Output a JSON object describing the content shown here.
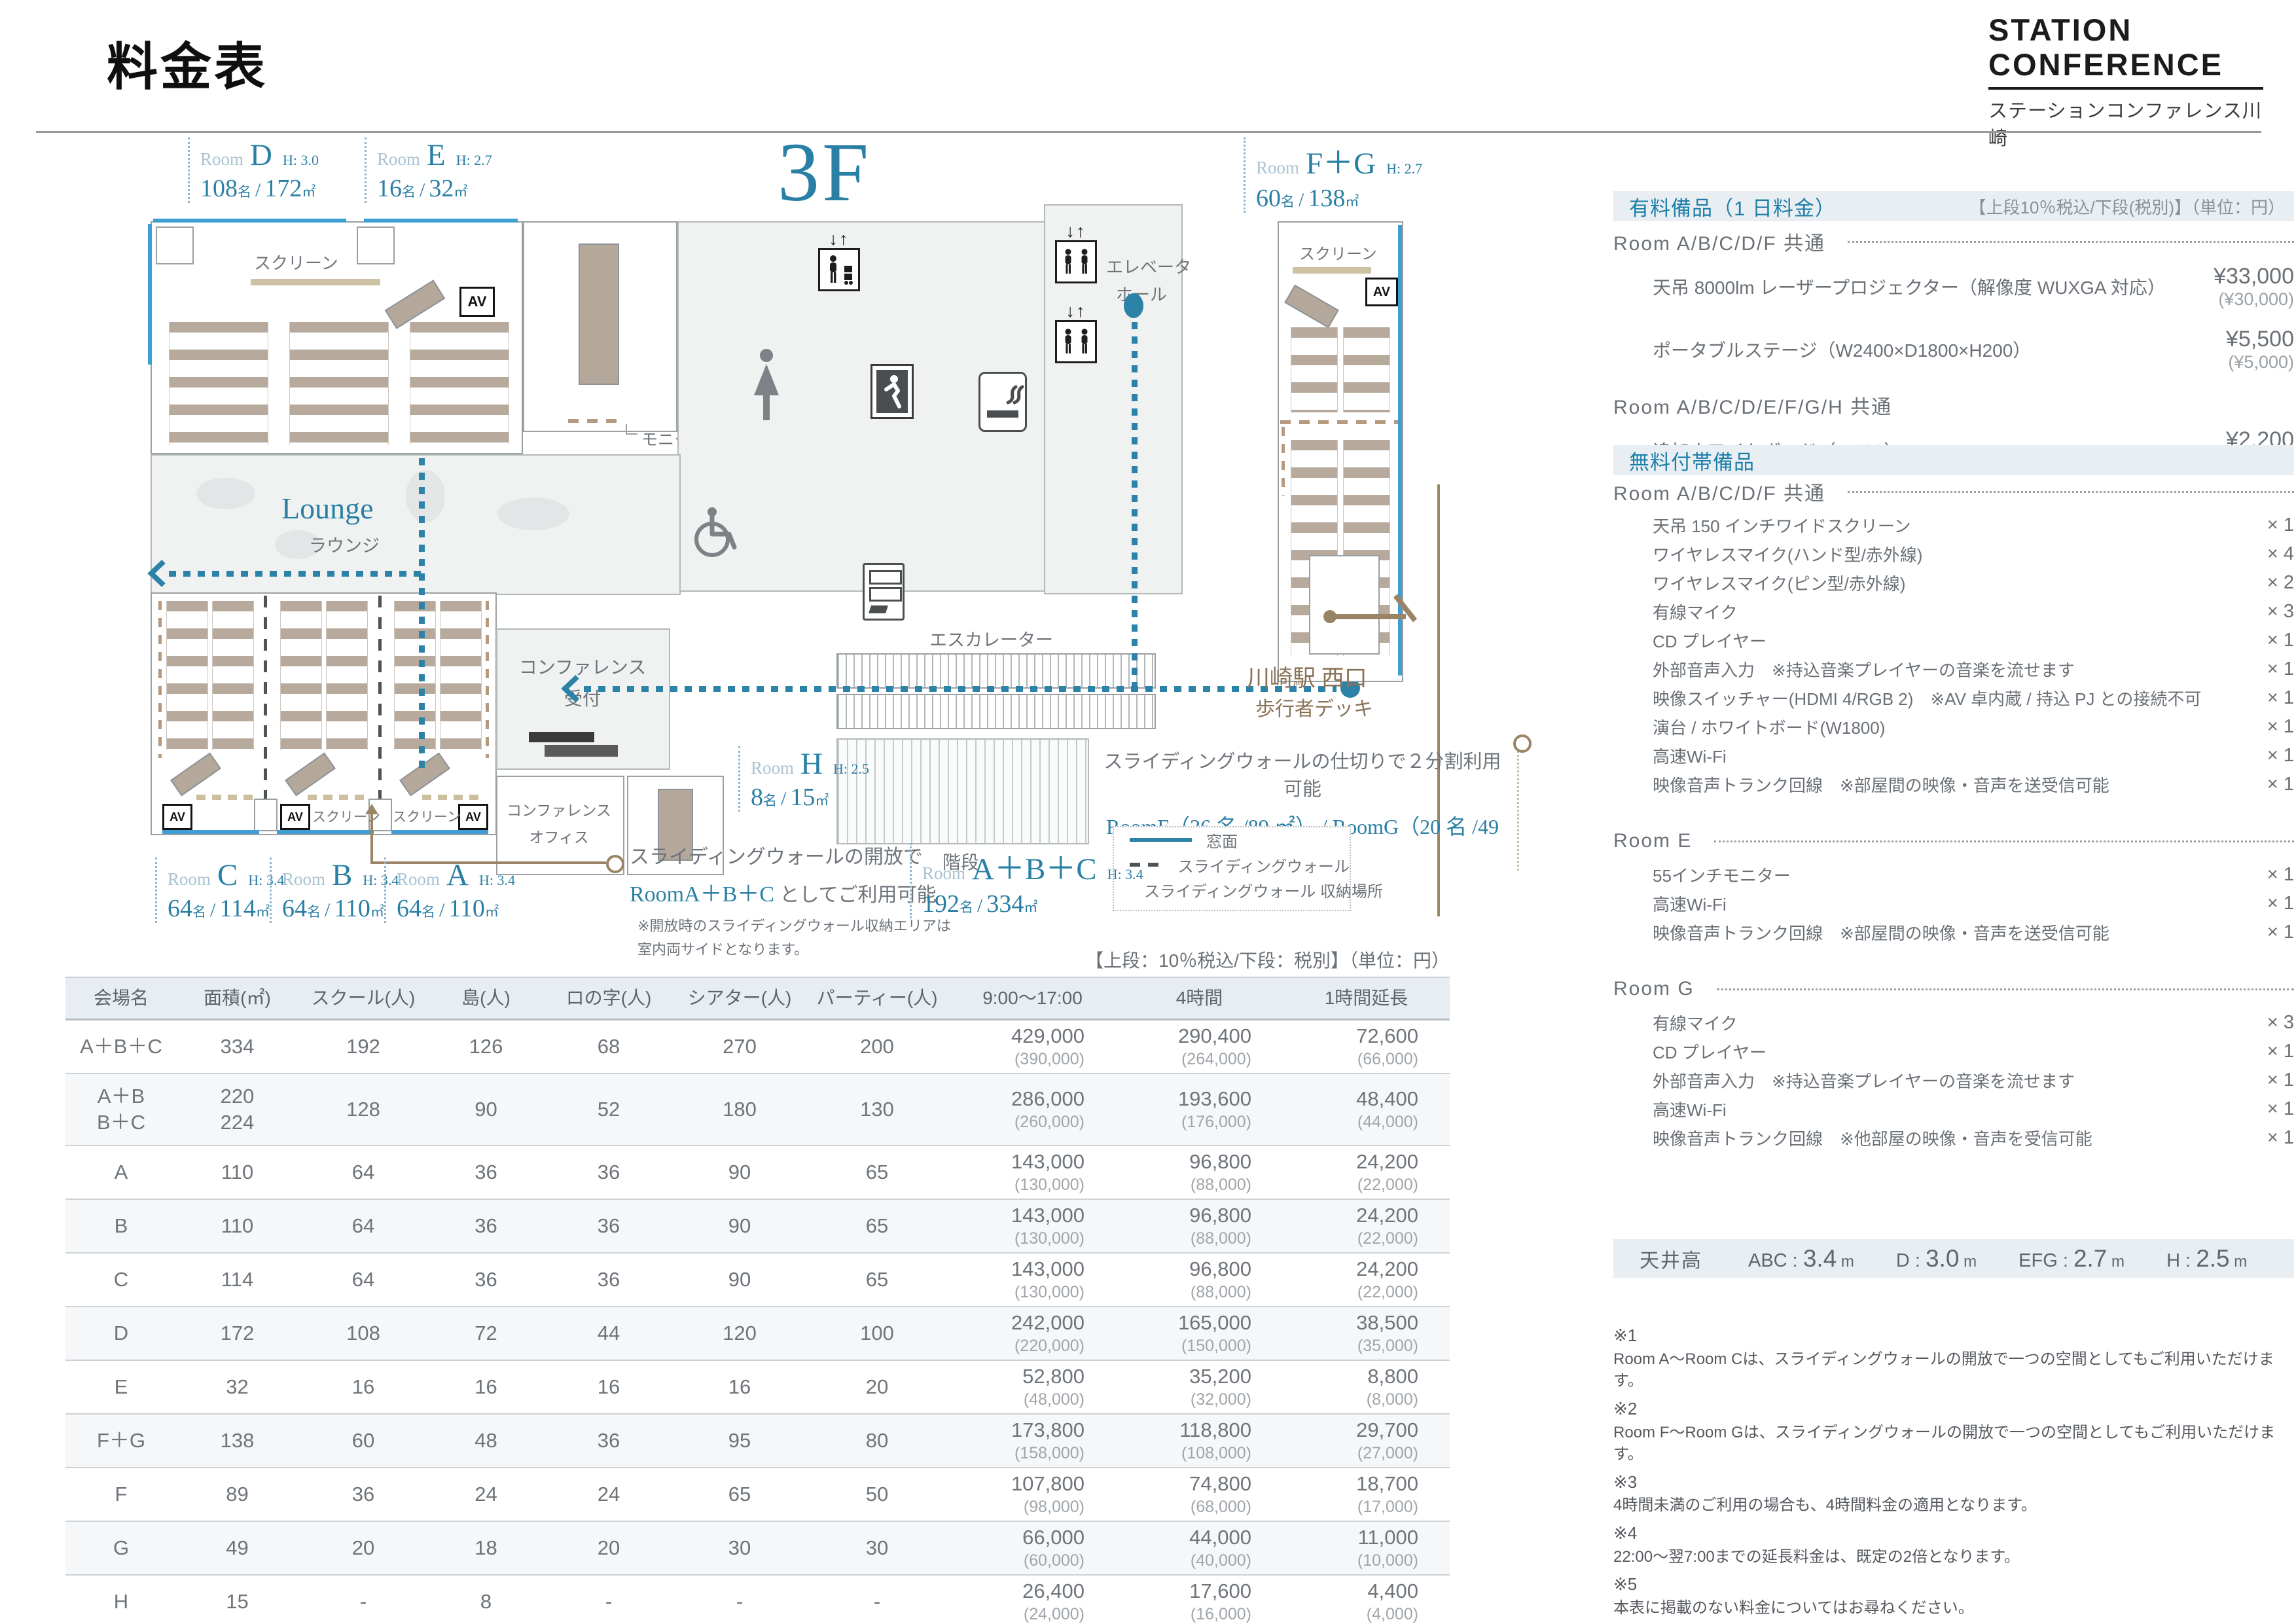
{
  "header": {
    "title": "料金表",
    "brand": {
      "line1": "STATION",
      "line2": "CONFERENCE",
      "subtitle": "ステーションコンファレンス川崎"
    }
  },
  "floor_plan": {
    "floor_label": "3F",
    "unit_name": "名",
    "unit_area": "㎡",
    "room_tags": [
      {
        "id": "d",
        "prefix": "Room",
        "letter": "D",
        "height": "H: 3.0",
        "capacity": "108",
        "area": "172"
      },
      {
        "id": "e",
        "prefix": "Room",
        "letter": "E",
        "height": "H: 2.7",
        "capacity": "16",
        "area": "32"
      },
      {
        "id": "fg",
        "prefix": "Room",
        "letter": "F＋G",
        "height": "H: 2.7",
        "capacity": "60",
        "area": "138"
      },
      {
        "id": "h",
        "prefix": "Room",
        "letter": "H",
        "height": "H: 2.5",
        "capacity": "8",
        "area": "15"
      },
      {
        "id": "c",
        "prefix": "Room",
        "letter": "C",
        "height": "H: 3.4",
        "capacity": "64",
        "area": "114"
      },
      {
        "id": "b",
        "prefix": "Room",
        "letter": "B",
        "height": "H: 3.4",
        "capacity": "64",
        "area": "110"
      },
      {
        "id": "a",
        "prefix": "Room",
        "letter": "A",
        "height": "H: 3.4",
        "capacity": "64",
        "area": "110"
      },
      {
        "id": "abc",
        "prefix": "Room",
        "letter": "A＋B＋C",
        "height": "H: 3.4",
        "capacity": "192",
        "area": "334"
      }
    ],
    "labels": {
      "screen": "スクリーン",
      "monitor": "モニター",
      "av": "AV",
      "elevator_hall_1": "エレベータ",
      "elevator_hall_2": "ホール",
      "escalator": "エスカレーター",
      "stairs": "階段",
      "lounge_en": "Lounge",
      "lounge_jp": "ラウンジ",
      "reception_1": "コンファレンス",
      "reception_2": "受付",
      "office_1": "コンファレンス",
      "office_2": "オフィス",
      "station_1": "川崎駅 西口",
      "station_2": "歩行者デッキ"
    },
    "notes": {
      "abc_open_1": "スライディングウォールの開放で",
      "abc_open_2_teal": "RoomA＋B＋C",
      "abc_open_2_rest": " としてご利用可能",
      "abc_open_3": "※開放時のスライディングウォール収納エリアは",
      "abc_open_4": "室内両サイドとなります。",
      "fg_split_1": "スライディングウォールの仕切りで２分割利用可能",
      "fg_split_2": "RoomF（36 名 /89 ㎡） / RoomG（20 名 /49 ㎡）"
    },
    "legend": [
      {
        "label": "窓面",
        "style": "window"
      },
      {
        "label": "スライディングウォール",
        "style": "sliding"
      },
      {
        "label": "スライディングウォール 収納場所",
        "style": "storage"
      }
    ]
  },
  "paid_equipment": {
    "bar_title": "有料備品（1 日料金）",
    "bar_note": "【上段10％税込/下段(税別)】（単位：円）",
    "groups": [
      {
        "heading": "Room A/B/C/D/F 共通",
        "leader": true,
        "items": [
          {
            "name": "天吊 8000lm レーザープロジェクター（解像度 WUXGA 対応）",
            "price": "¥33,000",
            "price_ex": "(¥30,000)"
          },
          {
            "name": "ポータブルステージ（W2400×D1800×H200）",
            "price": "¥5,500",
            "price_ex": "(¥5,000)"
          }
        ]
      },
      {
        "heading": "Room A/B/C/D/E/F/G/H 共通",
        "leader": false,
        "items": [
          {
            "name": "追加ホワイトボード（W900）",
            "price": "¥2,200",
            "price_ex": "(¥2,000)"
          }
        ]
      }
    ]
  },
  "free_equipment": {
    "bar_title": "無料付帯備品",
    "groups": [
      {
        "heading": "Room A/B/C/D/F 共通",
        "leader": true,
        "items": [
          {
            "name": "天吊 150 インチワイドスクリーン",
            "qty": "× 1"
          },
          {
            "name": "ワイヤレスマイク(ハンド型/赤外線)",
            "qty": "× 4"
          },
          {
            "name": "ワイヤレスマイク(ピン型/赤外線)",
            "qty": "× 2"
          },
          {
            "name": "有線マイク",
            "qty": "× 3"
          },
          {
            "name": "CD プレイヤー",
            "qty": "× 1"
          },
          {
            "name": "外部音声入力　※持込音楽プレイヤーの音楽を流せます",
            "qty": "× 1"
          },
          {
            "name": "映像スイッチャー(HDMI 4/RGB 2)　※AV 卓内蔵 / 持込 PJ との接続不可",
            "qty": "× 1"
          },
          {
            "name": "演台 / ホワイトボード(W1800)",
            "qty": "× 1"
          },
          {
            "name": "高速Wi-Fi",
            "qty": "× 1"
          },
          {
            "name": "映像音声トランク回線　※部屋間の映像・音声を送受信可能",
            "qty": "× 1"
          }
        ]
      },
      {
        "heading": "Room E",
        "leader": true,
        "items": [
          {
            "name": "55インチモニター",
            "qty": "× 1"
          },
          {
            "name": "高速Wi-Fi",
            "qty": "× 1"
          },
          {
            "name": "映像音声トランク回線　※部屋間の映像・音声を送受信可能",
            "qty": "× 1"
          }
        ]
      },
      {
        "heading": "Room G",
        "leader": true,
        "items": [
          {
            "name": "有線マイク",
            "qty": "× 3"
          },
          {
            "name": "CD プレイヤー",
            "qty": "× 1"
          },
          {
            "name": "外部音声入力　※持込音楽プレイヤーの音楽を流せます",
            "qty": "× 1"
          },
          {
            "name": "高速Wi-Fi",
            "qty": "× 1"
          },
          {
            "name": "映像音声トランク回線　※他部屋の映像・音声を受信可能",
            "qty": "× 1"
          }
        ]
      }
    ]
  },
  "ceiling": {
    "label": "天井高",
    "values": [
      {
        "k": "ABC : ",
        "v": "3.4",
        "u": " m"
      },
      {
        "k": "D : ",
        "v": "3.0",
        "u": " m"
      },
      {
        "k": "EFG : ",
        "v": "2.7",
        "u": " m"
      },
      {
        "k": "H : ",
        "v": "2.5",
        "u": " m"
      }
    ]
  },
  "footnotes": [
    {
      "mark": "※1",
      "text": "Room A～Room Cは、スライディングウォールの開放で一つの空間としてもご利用いただけます。"
    },
    {
      "mark": "※2",
      "text": "Room F～Room Gは、スライディングウォールの開放で一つの空間としてもご利用いただけます。"
    },
    {
      "mark": "※3",
      "text": "4時間未満のご利用の場合も、4時間料金の適用となります。"
    },
    {
      "mark": "※4",
      "text": "22:00～翌7:00までの延長料金は、既定の2倍となります。"
    },
    {
      "mark": "※5",
      "text": "本表に掲載のない料金についてはお尋ねください。"
    },
    {
      "mark": "※6",
      "text": "記載の天井高は最大高となります。会場によっては、一部下がり天井部分がございます。"
    }
  ],
  "price_table": {
    "tax_note": "【上段：10％税込/下段：税別】（単位：円）",
    "columns": [
      "会場名",
      "面積(㎡)",
      "スクール(人)",
      "島(人)",
      "ロの字(人)",
      "シアター(人)",
      "パーティー(人)",
      "9:00～17:00",
      "4時間",
      "1時間延長"
    ],
    "rows": [
      {
        "name": [
          "A＋B＋C"
        ],
        "area": [
          "334"
        ],
        "school": "192",
        "island": "126",
        "ro": "68",
        "theater": "270",
        "party": "200",
        "day": [
          "429,000",
          "(390,000)"
        ],
        "h4": [
          "290,400",
          "(264,000)"
        ],
        "ext": [
          "72,600",
          "(66,000)"
        ]
      },
      {
        "name": [
          "A＋B",
          "B＋C"
        ],
        "area": [
          "220",
          "224"
        ],
        "school": "128",
        "island": "90",
        "ro": "52",
        "theater": "180",
        "party": "130",
        "day": [
          "286,000",
          "(260,000)"
        ],
        "h4": [
          "193,600",
          "(176,000)"
        ],
        "ext": [
          "48,400",
          "(44,000)"
        ]
      },
      {
        "name": [
          "A"
        ],
        "area": [
          "110"
        ],
        "school": "64",
        "island": "36",
        "ro": "36",
        "theater": "90",
        "party": "65",
        "day": [
          "143,000",
          "(130,000)"
        ],
        "h4": [
          "96,800",
          "(88,000)"
        ],
        "ext": [
          "24,200",
          "(22,000)"
        ]
      },
      {
        "name": [
          "B"
        ],
        "area": [
          "110"
        ],
        "school": "64",
        "island": "36",
        "ro": "36",
        "theater": "90",
        "party": "65",
        "day": [
          "143,000",
          "(130,000)"
        ],
        "h4": [
          "96,800",
          "(88,000)"
        ],
        "ext": [
          "24,200",
          "(22,000)"
        ]
      },
      {
        "name": [
          "C"
        ],
        "area": [
          "114"
        ],
        "school": "64",
        "island": "36",
        "ro": "36",
        "theater": "90",
        "party": "65",
        "day": [
          "143,000",
          "(130,000)"
        ],
        "h4": [
          "96,800",
          "(88,000)"
        ],
        "ext": [
          "24,200",
          "(22,000)"
        ]
      },
      {
        "name": [
          "D"
        ],
        "area": [
          "172"
        ],
        "school": "108",
        "island": "72",
        "ro": "44",
        "theater": "120",
        "party": "100",
        "day": [
          "242,000",
          "(220,000)"
        ],
        "h4": [
          "165,000",
          "(150,000)"
        ],
        "ext": [
          "38,500",
          "(35,000)"
        ]
      },
      {
        "name": [
          "E"
        ],
        "area": [
          "32"
        ],
        "school": "16",
        "island": "16",
        "ro": "16",
        "theater": "16",
        "party": "20",
        "day": [
          "52,800",
          "(48,000)"
        ],
        "h4": [
          "35,200",
          "(32,000)"
        ],
        "ext": [
          "8,800",
          "(8,000)"
        ]
      },
      {
        "name": [
          "F＋G"
        ],
        "area": [
          "138"
        ],
        "school": "60",
        "island": "48",
        "ro": "36",
        "theater": "95",
        "party": "80",
        "day": [
          "173,800",
          "(158,000)"
        ],
        "h4": [
          "118,800",
          "(108,000)"
        ],
        "ext": [
          "29,700",
          "(27,000)"
        ]
      },
      {
        "name": [
          "F"
        ],
        "area": [
          "89"
        ],
        "school": "36",
        "island": "24",
        "ro": "24",
        "theater": "65",
        "party": "50",
        "day": [
          "107,800",
          "(98,000)"
        ],
        "h4": [
          "74,800",
          "(68,000)"
        ],
        "ext": [
          "18,700",
          "(17,000)"
        ]
      },
      {
        "name": [
          "G"
        ],
        "area": [
          "49"
        ],
        "school": "20",
        "island": "18",
        "ro": "20",
        "theater": "30",
        "party": "30",
        "day": [
          "66,000",
          "(60,000)"
        ],
        "h4": [
          "44,000",
          "(40,000)"
        ],
        "ext": [
          "11,000",
          "(10,000)"
        ]
      },
      {
        "name": [
          "H"
        ],
        "area": [
          "15"
        ],
        "school": "-",
        "island": "8",
        "ro": "-",
        "theater": "-",
        "party": "-",
        "day": [
          "26,400",
          "(24,000)"
        ],
        "h4": [
          "17,600",
          "(16,000)"
        ],
        "ext": [
          "4,400",
          "(4,000)"
        ]
      }
    ]
  }
}
